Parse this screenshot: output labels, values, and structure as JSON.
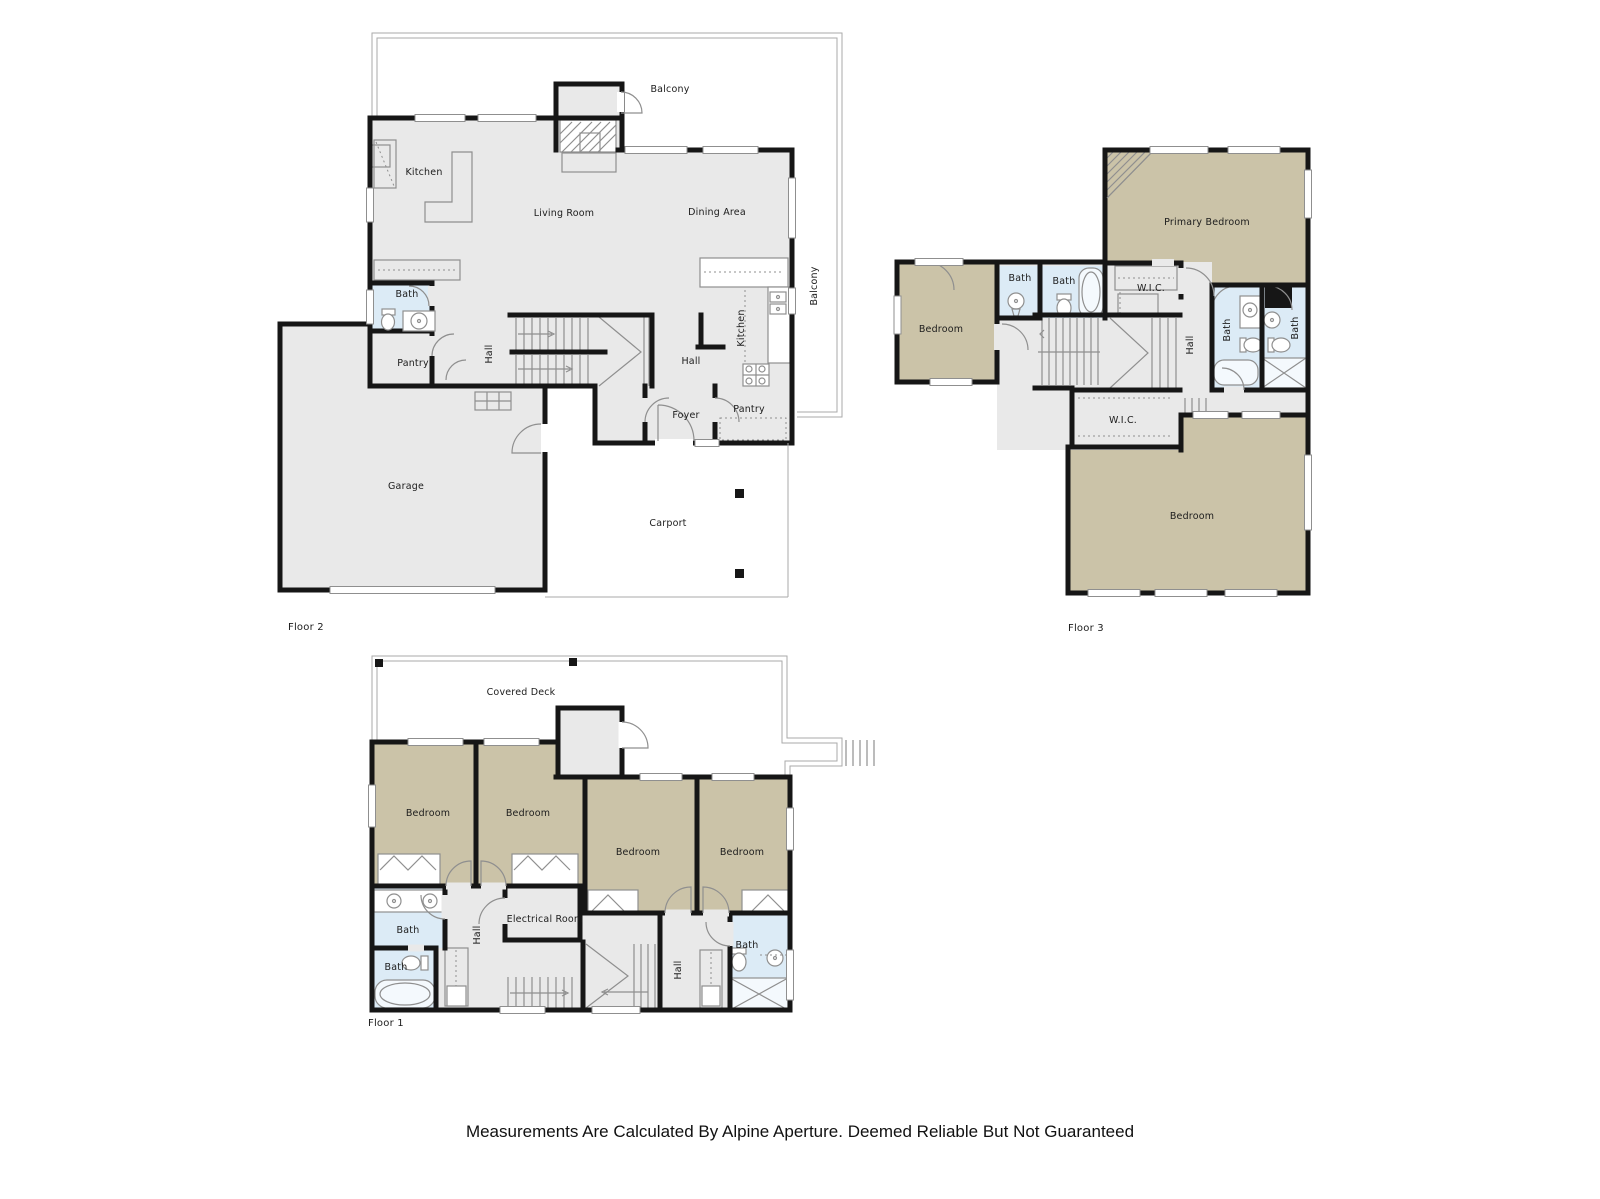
{
  "palette": {
    "wall": "#161616",
    "room_gray": "#e9e9e9",
    "bedroom_tan": "#cbc3a8",
    "bath_blue": "#dcebf6",
    "outline_gray": "#8f8f8f",
    "label": "#1c1c1c",
    "background": "#ffffff"
  },
  "floors": {
    "floor2": {
      "label": "Floor 2",
      "rooms": {
        "balcony_top": "Balcony",
        "kitchen": "Kitchen",
        "living_room": "Living Room",
        "dining_area": "Dining Area",
        "bath": "Bath",
        "pantry": "Pantry",
        "hall_stairs": "Hall",
        "hall": "Hall",
        "kitchen2": "Kitchen",
        "balcony_side": "Balcony",
        "foyer": "Foyer",
        "pantry2": "Pantry",
        "garage": "Garage",
        "carport": "Carport"
      }
    },
    "floor3": {
      "label": "Floor 3",
      "rooms": {
        "primary_bedroom": "Primary Bedroom",
        "bedroom_left": "Bedroom",
        "bath1": "Bath",
        "bath2": "Bath",
        "wic_top": "W.I.C.",
        "hall": "Hall",
        "bath3": "Bath",
        "bath4": "Bath",
        "wic_lower": "W.I.C.",
        "bedroom_lower": "Bedroom"
      }
    },
    "floor1": {
      "label": "Floor 1",
      "rooms": {
        "covered_deck": "Covered Deck",
        "bedroom1": "Bedroom",
        "bedroom2": "Bedroom",
        "bedroom3": "Bedroom",
        "bedroom4": "Bedroom",
        "bath_upper": "Bath",
        "bath_lower": "Bath",
        "hall_left": "Hall",
        "electrical_room": "Electrical Room",
        "hall_right": "Hall",
        "bath_right": "Bath"
      }
    }
  },
  "footer": {
    "disclaimer": "Measurements Are Calculated By Alpine Aperture. Deemed Reliable But Not Guaranteed"
  }
}
